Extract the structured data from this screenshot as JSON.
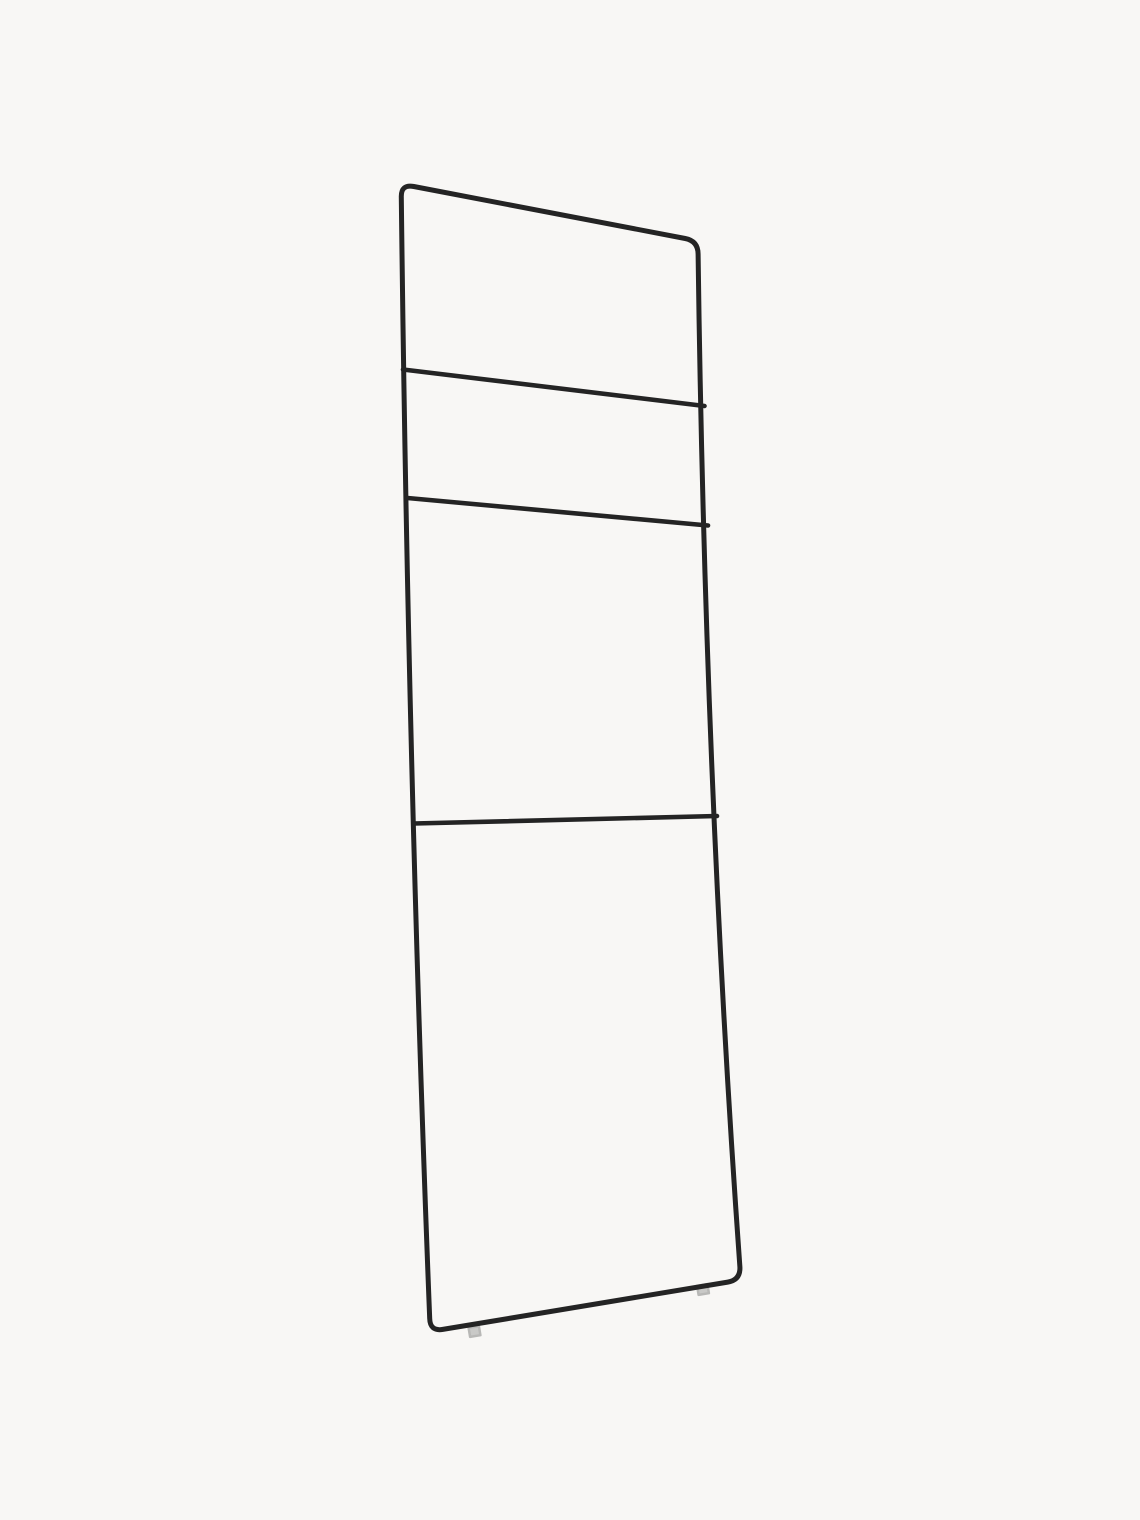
{
  "scene": {
    "type": "product-photo",
    "subject": "Black metal towel ladder rack with three rungs, leaning at a slight angle, with small light-grey protective feet on the bottom bar, photographed on a plain off-white studio background",
    "background_color": "#f8f7f5",
    "frame_color": "#242424",
    "foot_fill_color": "#c9c9c7",
    "foot_stroke_color": "#b8b8b6",
    "canvas_width": "1140",
    "canvas_height": "1520"
  },
  "ladder": {
    "frame_stroke_width": "5",
    "rung_stroke_width": "4.6",
    "frame_path": "M413.8 186.5 L685.2 238.5 Q698 241 698.1 254 Q705 780 739.9 1267 Q740.5 1280 727.7 1282.1 L442.8 1329.4 Q430 1331.5 429.7 1318.5 Q408 770 401.3 197 Q401 184 413.8 186.5 Z",
    "rungs": [
      {
        "name": "rung-1",
        "path": "M403 369.5 L704.5 406"
      },
      {
        "name": "rung-2",
        "path": "M407.5 498 L708 525.5"
      },
      {
        "name": "rung-3",
        "path": "M414 823.5 L717 816"
      }
    ],
    "feet": [
      {
        "name": "foot-left",
        "path": "M468.6 1327.8 L478.9 1326.1 L480.4 1335.2 L470.1 1336.9 Z"
      },
      {
        "name": "foot-right",
        "path": "M697.1 1285.8 L707.4 1284.1 L708.9 1293.2 L698.6 1294.9 Z"
      }
    ]
  }
}
